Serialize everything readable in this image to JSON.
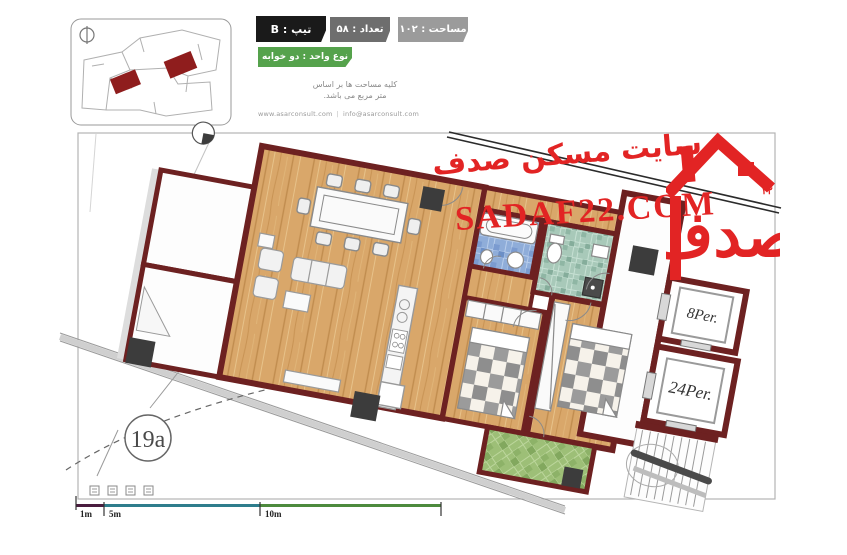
{
  "header": {
    "badges": {
      "type": {
        "label": "تیپ : B",
        "bg": "#1a1a1a"
      },
      "count": {
        "label": "تعداد : ۵۸",
        "bg": "#6e6e6e"
      },
      "area": {
        "label": "مساحت : ۱۰۲",
        "bg": "#9b9b9b"
      },
      "unit": {
        "label": "نوع واحد : دو خوابه",
        "bg": "#55a24c"
      }
    },
    "notes": {
      "line1": "کلیه مساحت ها بر اساس",
      "line2": "متر مربع می باشد.",
      "site": "www.asarconsult.com",
      "divider": "|",
      "email": "info@asarconsult.com"
    }
  },
  "watermark": {
    "fa": "سایت مسکن صدف",
    "en": "SADAF22.COM",
    "logo_number": "۲۲",
    "color": "#e22424"
  },
  "plan": {
    "elevator_small": "8Per.",
    "elevator_large": "24Per.",
    "detail_ref": "19a",
    "wall_color": "#6d2121",
    "wood_color": "#d9a76a",
    "bath_blue": "#8fadd9",
    "bath_green": "#a8c9b9",
    "balcony_green": "#9dbf77"
  },
  "scale_bar": {
    "labels": [
      "1m",
      "5m",
      "10m"
    ],
    "colors": [
      "#4a1d3f",
      "#2e7d8c",
      "#4d8a3d"
    ]
  }
}
